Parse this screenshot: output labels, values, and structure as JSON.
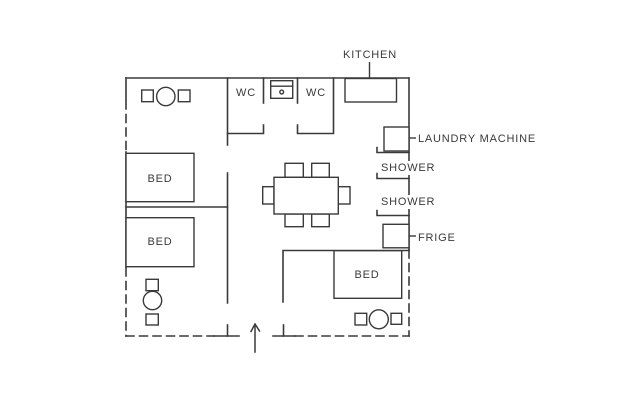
{
  "floor_plan": {
    "colors": {
      "background": "#ffffff",
      "line": "#3a3a3a",
      "text": "#3a3a3a"
    },
    "labels": {
      "kitchen": "KITCHEN",
      "wc_left": "WC",
      "wc_right": "WC",
      "laundry_machine": "LAUNDRY MACHINE",
      "shower_upper": "SHOWER",
      "shower_lower": "SHOWER",
      "frige": "FRIGE",
      "bed_upper_left": "BED",
      "bed_lower_left": "BED",
      "bed_bottom_right": "BED"
    },
    "icons": [
      {
        "name": "kitchen-counter-icon",
        "shape": "rectangle"
      },
      {
        "name": "sink-icon",
        "shape": "rectangle-with-knob"
      },
      {
        "name": "laundry-machine-icon",
        "shape": "square"
      },
      {
        "name": "frige-icon",
        "shape": "square"
      },
      {
        "name": "bed-icon",
        "shape": "rectangle",
        "count": 3
      },
      {
        "name": "dining-table-icon",
        "shape": "rectangle",
        "chairs": 6
      },
      {
        "name": "side-table-set-icon",
        "shape": "square-circle-square",
        "count": 3
      },
      {
        "name": "entry-door-icon",
        "shape": "arrow-line"
      },
      {
        "name": "shower-partition-icon",
        "shape": "line-with-tick",
        "count": 3
      }
    ]
  }
}
